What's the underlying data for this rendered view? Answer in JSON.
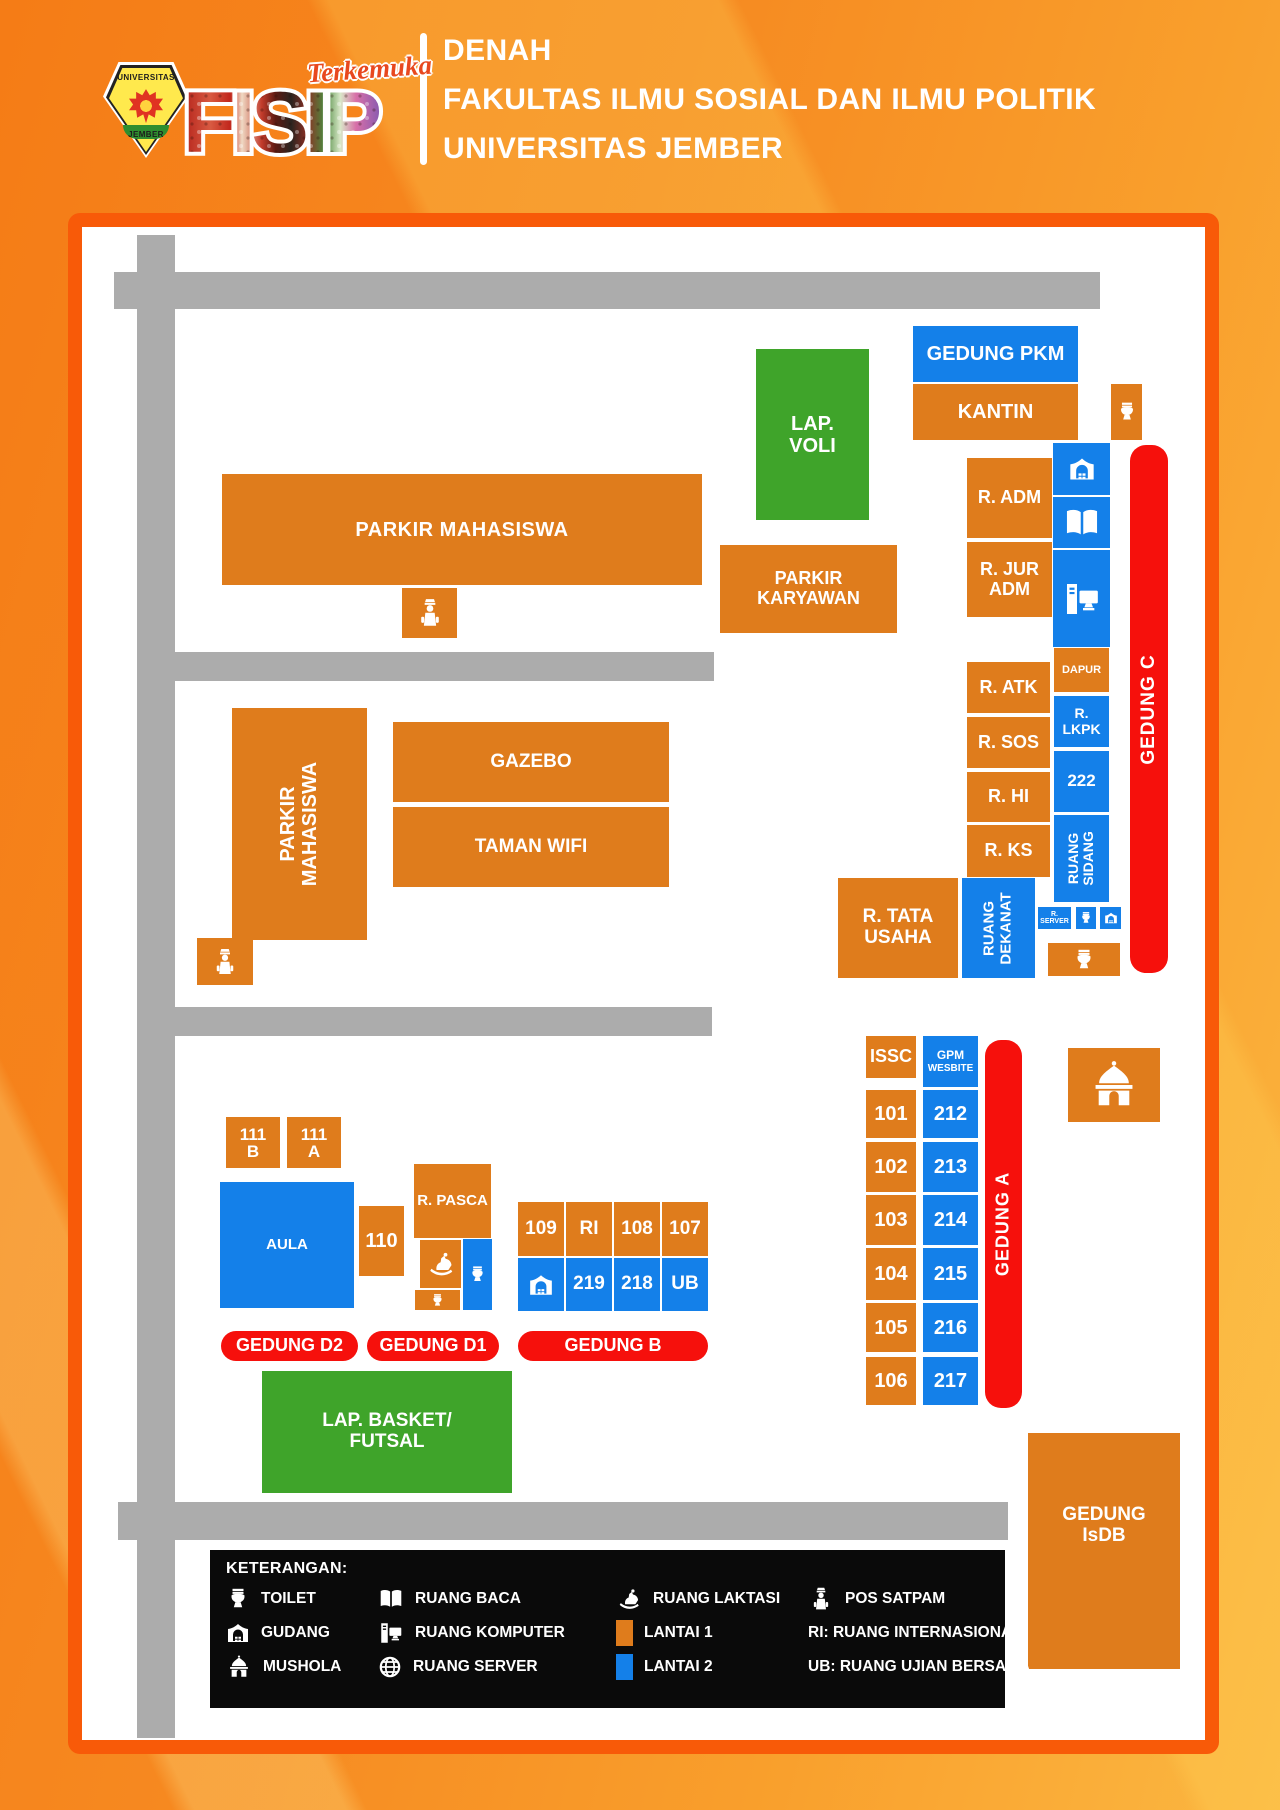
{
  "header": {
    "title_lines": [
      "DENAH",
      "FAKULTAS ILMU SOSIAL DAN ILMU POLITIK",
      "UNIVERSITAS JEMBER"
    ],
    "logo": {
      "emblem_top": "UNIVERSITAS",
      "emblem_bottom": "JEMBER",
      "acronym": "FISIP",
      "tagline": "Terkemuka"
    }
  },
  "map": {
    "buildings": {
      "gedung_pkm": "GEDUNG PKM",
      "kantin": "KANTIN",
      "lap_voli": [
        "LAP.",
        "VOLI"
      ],
      "parkir_mahasiswa_top": "PARKIR MAHASISWA",
      "parkir_karyawan": [
        "PARKIR",
        "KARYAWAN"
      ],
      "r_adm": "R. ADM",
      "r_jur_adm": [
        "R. JUR",
        "ADM"
      ],
      "dapur": "DAPUR",
      "r_lkpk": [
        "R.",
        "LKPK"
      ],
      "room_222": "222",
      "ruang_sidang": [
        "RUANG",
        "SIDANG"
      ],
      "r_server": [
        "R.",
        "SERVER"
      ],
      "gedung_c": "GEDUNG C",
      "r_atk": "R. ATK",
      "r_sos": "R. SOS",
      "r_hi": "R. HI",
      "r_ks": "R. KS",
      "r_tata_usaha": [
        "R. TATA",
        "USAHA"
      ],
      "ruang_dekanat": [
        "RUANG",
        "DEKANAT"
      ],
      "parkir_mahasiswa_side": [
        "PARKIR",
        "MAHASISWA"
      ],
      "gazebo": "GAZEBO",
      "taman_wifi": "TAMAN WIFI",
      "issc": "ISSC",
      "gpm": [
        "GPM",
        "WESBITE"
      ],
      "gedung_a": "GEDUNG A",
      "b111b": [
        "111",
        "B"
      ],
      "b111a": [
        "111",
        "A"
      ],
      "aula": "AULA",
      "b110": "110",
      "r_pasca": "R. PASCA",
      "gedung_d2": "GEDUNG D2",
      "gedung_d1": "GEDUNG D1",
      "gedung_b": "GEDUNG B",
      "lap_basket": [
        "LAP. BASKET/",
        "FUTSAL"
      ],
      "gedung_isdb": [
        "GEDUNG",
        "IsDB"
      ]
    },
    "gedung_a_rows": [
      [
        "101",
        "212"
      ],
      [
        "102",
        "213"
      ],
      [
        "103",
        "214"
      ],
      [
        "104",
        "215"
      ],
      [
        "105",
        "216"
      ],
      [
        "106",
        "217"
      ]
    ],
    "gedung_b_top": [
      "109",
      "RI",
      "108",
      "107"
    ],
    "gedung_b_bottom": [
      "219",
      "218",
      "UB"
    ]
  },
  "legend": {
    "title": "KETERANGAN:",
    "items": [
      {
        "icon": "toilet-icon",
        "label": "TOILET"
      },
      {
        "icon": "book-icon",
        "label": "RUANG BACA"
      },
      {
        "icon": "laktasi-icon",
        "label": "RUANG LAKTASI"
      },
      {
        "icon": "satpam-icon",
        "label": "POS SATPAM"
      },
      {
        "icon": "gudang-icon",
        "label": "GUDANG"
      },
      {
        "icon": "computer-icon",
        "label": "RUANG KOMPUTER"
      },
      {
        "icon": "lantai1-swatch",
        "label": "LANTAI 1"
      },
      {
        "icon": "none",
        "label": "RI: RUANG INTERNASIONAL"
      },
      {
        "icon": "mushola-icon",
        "label": "MUSHOLA"
      },
      {
        "icon": "globe-icon",
        "label": "RUANG SERVER"
      },
      {
        "icon": "lantai2-swatch",
        "label": "LANTAI 2"
      },
      {
        "icon": "none",
        "label": "UB: RUANG UJIAN BERSAMA"
      }
    ]
  },
  "colors": {
    "lantai1_orange": "#DF7C1C",
    "lantai2_blue": "#1480E9",
    "field_green": "#3FA42A",
    "marker_red": "#F6100C",
    "road_gray": "#ACACAC",
    "frame_orange": "#F85A08"
  }
}
